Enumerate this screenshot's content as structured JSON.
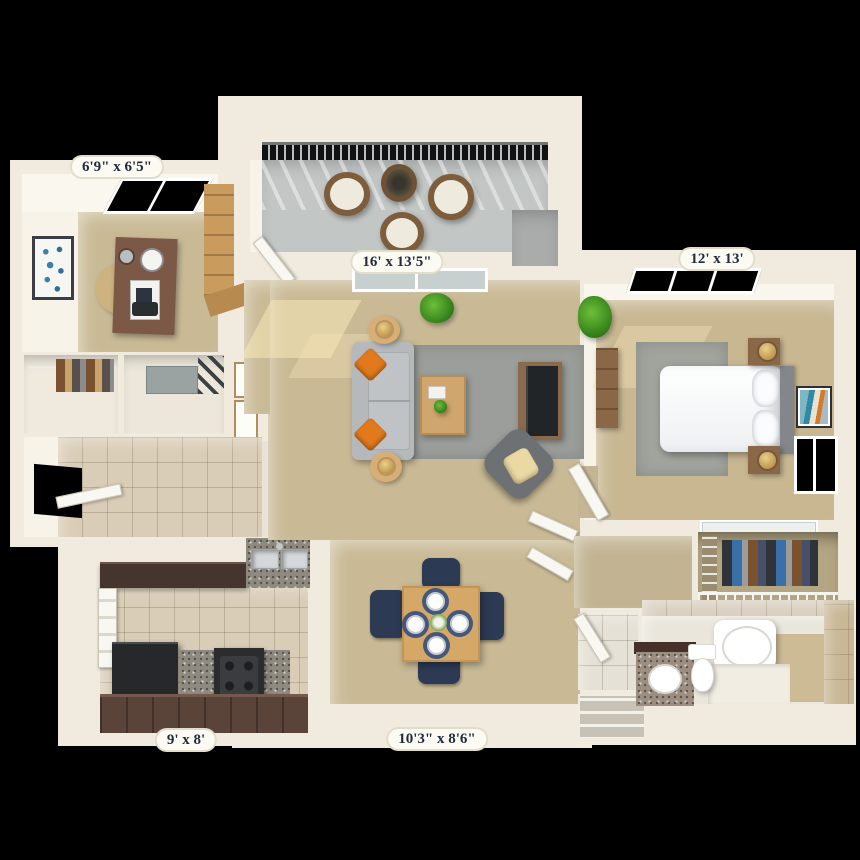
{
  "scene": {
    "type": "3D apartment floor plan, top-down render",
    "background": "#000000"
  },
  "palette": {
    "wall": "#f0ebde",
    "carpet": "#c9ba95",
    "tile_floor": "#dacdb8",
    "balcony_concrete": "#c2c6c5",
    "area_rug": "#9b9e9a",
    "kitchen_cabinet_dark": "#46352f",
    "wood_furniture": "#cfa66d",
    "sofa_gray": "#b6b9bb",
    "accent_pillow_orange": "#e2791c",
    "dining_chair_navy": "#2c3a54",
    "plant_green": "#2f7a16",
    "label_text": "#222b3a",
    "label_background": "#fcfbf3"
  },
  "rooms": {
    "den": {
      "dimensions": "6'9\" x 6'5\""
    },
    "balcony": {
      "dimensions": "16' x 13'5\""
    },
    "bedroom": {
      "dimensions": "12' x 13'"
    },
    "kitchen": {
      "dimensions": "9' x 8'"
    },
    "living_dining": {
      "dimensions": "10'3\" x 8'6\""
    }
  }
}
